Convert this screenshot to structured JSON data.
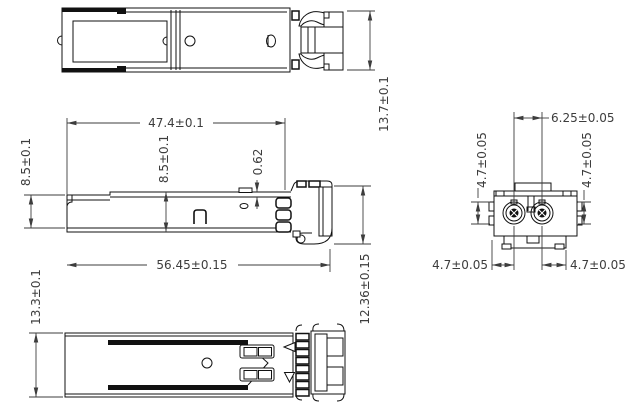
{
  "drawing": {
    "background_color": "#ffffff",
    "line_color": "#111111",
    "dimension_color": "#3d3d3d",
    "dimensions": {
      "top_view_width": "13.7±0.1",
      "side_view_body_length": "47.4±0.1",
      "side_view_front_height": "8.5±0.1",
      "side_view_body_height": "8.5±0.1",
      "side_view_top_wall": "0.62",
      "side_view_overall_length": "56.45±0.15",
      "side_view_rear_height": "12.36±0.15",
      "bottom_view_width": "13.3±0.1",
      "front_view_port_pitch": "6.25±0.05",
      "front_view_left_port_height": "4.7±0.05",
      "front_view_right_port_height": "4.7±0.05",
      "front_view_left_port_offset": "4.7±0.05",
      "front_view_right_port_offset": "4.7±0.05"
    }
  }
}
